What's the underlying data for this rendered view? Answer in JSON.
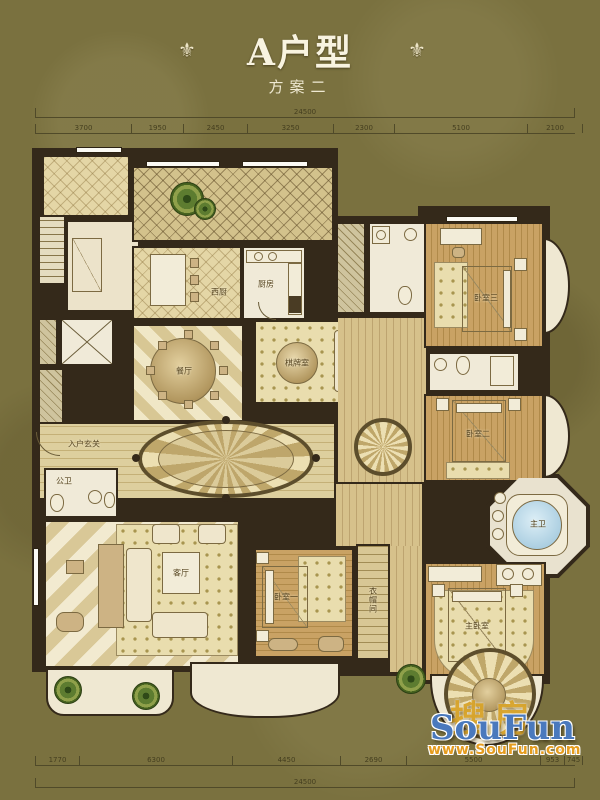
{
  "page": {
    "title": "A户型",
    "subtitle": "方案二",
    "ornament_left": "⚜",
    "ornament_right": "⚜"
  },
  "rooms": {
    "entry_foyer": "入户玄关",
    "maid_room": "工人房",
    "west_kitchen": "西厨",
    "kitchen": "厨房",
    "dining": "餐厅",
    "game_room": "棋牌室",
    "living": "客厅",
    "bedroom1": "卧室一",
    "bedroom2": "卧室二",
    "bedroom3": "卧室三",
    "master_bedroom": "主卧室",
    "master_bath": "主卫",
    "guest_bath": "公卫",
    "closet": "衣帽间"
  },
  "dimensions": {
    "top_total": "24500",
    "top_segments": [
      "3700",
      "1950",
      "2450",
      "3250",
      "2300",
      "5100",
      "2100"
    ],
    "bottom_total": "24500",
    "bottom_segments": [
      "1770",
      "6300",
      "4450",
      "2690",
      "5500",
      "953",
      "745"
    ]
  },
  "watermark": {
    "zh": "搜房",
    "en": "SouFun",
    "url": "www.SouFun.com"
  },
  "colors": {
    "background": "#7a713f",
    "wall": "#34291a",
    "brand_blue": "#4a79bd",
    "brand_orange": "#e59c1e",
    "brand_gold": "#d8a42b"
  }
}
